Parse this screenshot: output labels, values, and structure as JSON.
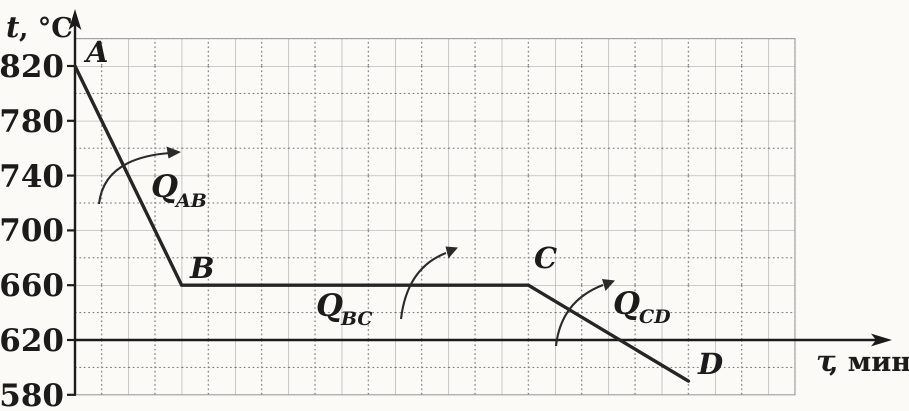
{
  "figure": {
    "description": "Cooling graph of a substance: temperature t (°C) versus time τ (minutes), segments AB (cooling), BC (plateau at 660 °C), CD (cooling), with heat-release annotations"
  },
  "axes": {
    "y_label_symbol": "t",
    "y_label_unit": ", °C",
    "x_label_symbol": "τ",
    "x_label_unit": ", мин",
    "y_ticks": [
      "820",
      "780",
      "740",
      "700",
      "660",
      "620",
      "580"
    ]
  },
  "point_labels": {
    "a": "A",
    "b": "B",
    "c": "C",
    "d": "D"
  },
  "heat_labels": {
    "q_ab": {
      "main": "Q",
      "sub": "AB"
    },
    "q_bc": {
      "main": "Q",
      "sub": "BC"
    },
    "q_cd": {
      "main": "Q",
      "sub": "CD"
    }
  },
  "colors": {
    "ink": "#1b1b1b",
    "curve": "#252525",
    "grid_solid": "#9d9d9d",
    "grid_dotted": "#6f6f6f",
    "paper": "#fbfaf6"
  },
  "chart_data": {
    "type": "line",
    "title": "",
    "xlabel": "τ, мин",
    "ylabel": "t, °C",
    "x_note": "x-axis has no numeric tick labels; x given in grid divisions (one division = one small square)",
    "points": [
      {
        "label": "A",
        "x": 0,
        "y": 820
      },
      {
        "label": "B",
        "x": 4,
        "y": 660
      },
      {
        "label": "C",
        "x": 17,
        "y": 660
      },
      {
        "label": "D",
        "x": 23,
        "y": 590
      }
    ],
    "y_ticks": [
      820,
      780,
      740,
      700,
      660,
      620,
      580
    ],
    "ylim": [
      580,
      840
    ],
    "xlim_divisions": [
      0,
      27
    ],
    "x_axis_drawn_at_y": 620,
    "grid": "graph paper: solid line every 40 °C / every 2 divisions, dotted line every 20 °C / 1 division",
    "legend": "none",
    "annotations": [
      {
        "label": "Q_AB",
        "meaning": "heat released on segment AB",
        "arrow": "curved arrow crossing segment AB"
      },
      {
        "label": "Q_BC",
        "meaning": "heat released on segment BC",
        "arrow": "curved arrow crossing segment BC"
      },
      {
        "label": "Q_CD",
        "meaning": "heat released on segment CD",
        "arrow": "curved arrow crossing segment CD"
      }
    ]
  }
}
